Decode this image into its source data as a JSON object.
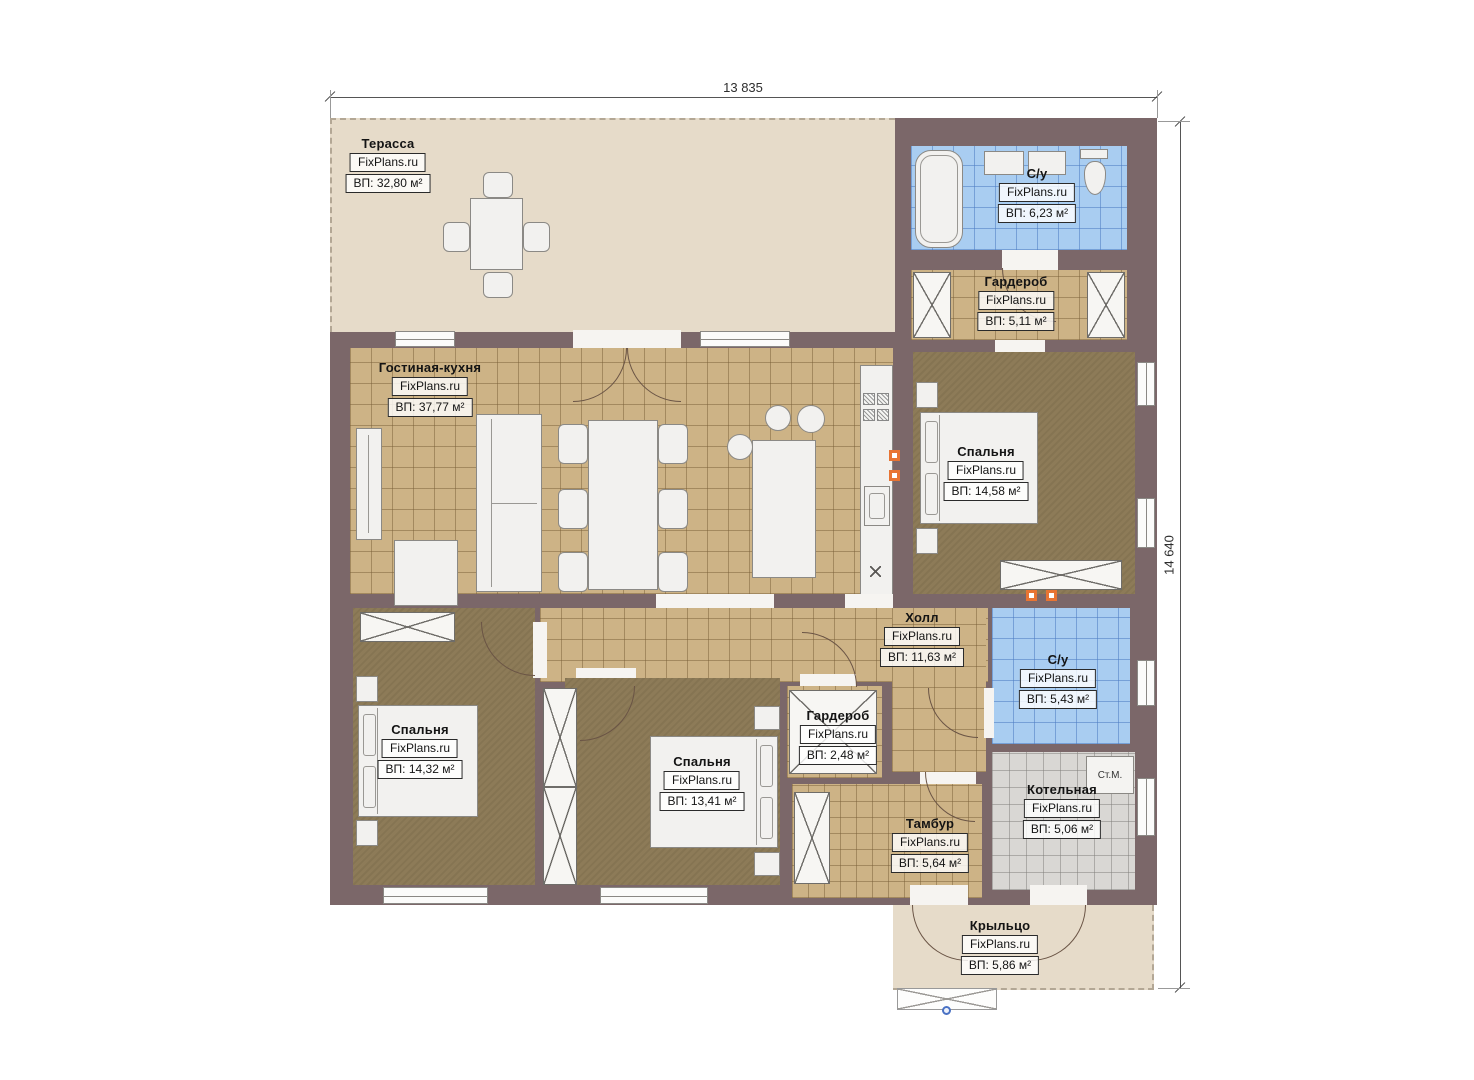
{
  "dimensions": {
    "width_mm": "13 835",
    "height_mm": "14 640"
  },
  "brand": "FixPlans.ru",
  "rooms": [
    {
      "id": "terrace",
      "name": "Терасса",
      "brand": "FixPlans.ru",
      "area": "ВП: 32,80 м²"
    },
    {
      "id": "bathroom-1",
      "name": "С/у",
      "brand": "FixPlans.ru",
      "area": "ВП: 6,23 м²"
    },
    {
      "id": "wardrobe-1",
      "name": "Гардероб",
      "brand": "FixPlans.ru",
      "area": "ВП: 5,11 м²"
    },
    {
      "id": "living-kitchen",
      "name": "Гостиная-кухня",
      "brand": "FixPlans.ru",
      "area": "ВП: 37,77 м²"
    },
    {
      "id": "bedroom-1",
      "name": "Спальня",
      "brand": "FixPlans.ru",
      "area": "ВП: 14,58 м²"
    },
    {
      "id": "hall",
      "name": "Холл",
      "brand": "FixPlans.ru",
      "area": "ВП: 11,63 м²"
    },
    {
      "id": "bathroom-2",
      "name": "С/у",
      "brand": "FixPlans.ru",
      "area": "ВП: 5,43 м²"
    },
    {
      "id": "wardrobe-2",
      "name": "Гардероб",
      "brand": "FixPlans.ru",
      "area": "ВП: 2,48 м²"
    },
    {
      "id": "bedroom-2",
      "name": "Спальня",
      "brand": "FixPlans.ru",
      "area": "ВП: 14,32 м²"
    },
    {
      "id": "bedroom-3",
      "name": "Спальня",
      "brand": "FixPlans.ru",
      "area": "ВП: 13,41 м²"
    },
    {
      "id": "tambour",
      "name": "Тамбур",
      "brand": "FixPlans.ru",
      "area": "ВП: 5,64 м²"
    },
    {
      "id": "boiler-room",
      "name": "Котельная",
      "brand": "FixPlans.ru",
      "area": "ВП: 5,06 м²"
    },
    {
      "id": "porch",
      "name": "Крыльцо",
      "brand": "FixPlans.ru",
      "area": "ВП: 5,86 м²"
    }
  ],
  "annotations": {
    "washing_machine": "Ст.М."
  },
  "colors": {
    "wall": "#7b6769",
    "tile_tan": "#cdb386",
    "tile_blue": "#a9cdf1",
    "tile_gray": "#d9d7d4",
    "floor_dark": "#8d7b58",
    "floor_beige": "#e6dbc9",
    "marker_orange": "#e87433"
  }
}
